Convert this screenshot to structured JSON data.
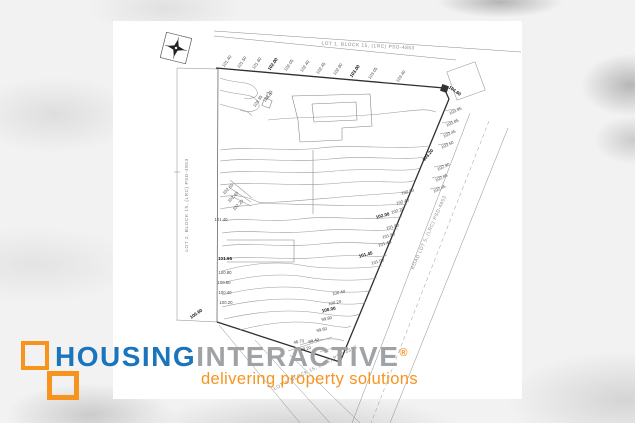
{
  "image": {
    "description": "Topographic contour survey plan of a subdivision lot (property listing photo)",
    "background_color": "#f2f2f2",
    "photo_background": "#ffffff"
  },
  "logo": {
    "word1": "HOUSING",
    "word2": "INTERACTIVE",
    "registered": "®",
    "tagline": "delivering property solutions",
    "colors": {
      "blue": "#1b75bc",
      "gray": "#a0a3a6",
      "orange": "#f7941e"
    }
  },
  "map": {
    "parcel_labels": [
      {
        "t": "LOT 1, BLOCK 15, (LRC) PSD-4853",
        "x": 368,
        "y": 47,
        "r": 3
      },
      {
        "t": "LOT 2, BLOCK 15, (LRC) PSD-4853",
        "x": 188,
        "y": 205,
        "r": -90
      },
      {
        "t": "ROAD LOT 5, (LRC) PSD-4853",
        "x": 430,
        "y": 233,
        "r": -66
      },
      {
        "t": "LOT 4, BLOCK 15, (LRC) PSD-4853",
        "x": 316,
        "y": 369,
        "r": -27
      }
    ],
    "elevation_labels": [
      {
        "t": "101.40",
        "x": 228,
        "y": 62,
        "r": -55
      },
      {
        "t": "101.50",
        "x": 243,
        "y": 63,
        "r": -55
      },
      {
        "t": "101.80",
        "x": 258,
        "y": 64,
        "r": -55
      },
      {
        "t": "102.00",
        "x": 274,
        "y": 65,
        "r": -55,
        "b": true
      },
      {
        "t": "102.05",
        "x": 290,
        "y": 66,
        "r": -55
      },
      {
        "t": "102.40",
        "x": 306,
        "y": 67,
        "r": -55
      },
      {
        "t": "102.45",
        "x": 322,
        "y": 69,
        "r": -55
      },
      {
        "t": "102.90",
        "x": 339,
        "y": 70,
        "r": -55
      },
      {
        "t": "103.00",
        "x": 356,
        "y": 72,
        "r": -55,
        "b": true
      },
      {
        "t": "103.05",
        "x": 374,
        "y": 74,
        "r": -55
      },
      {
        "t": "103.40",
        "x": 402,
        "y": 77,
        "r": -55
      },
      {
        "t": "103.35",
        "x": 259,
        "y": 102,
        "r": -55
      },
      {
        "t": "103.45",
        "x": 269,
        "y": 97,
        "r": -55
      },
      {
        "t": "104.60",
        "x": 454,
        "y": 92,
        "r": 35,
        "b": true
      },
      {
        "t": "103.95",
        "x": 456,
        "y": 112,
        "r": -25
      },
      {
        "t": "103.85",
        "x": 453,
        "y": 124,
        "r": -25
      },
      {
        "t": "103.45",
        "x": 450,
        "y": 135,
        "r": -25
      },
      {
        "t": "103.50",
        "x": 448,
        "y": 146,
        "r": -25
      },
      {
        "t": "103.20",
        "x": 429,
        "y": 156,
        "r": -50,
        "b": true
      },
      {
        "t": "102.90",
        "x": 444,
        "y": 168,
        "r": -25
      },
      {
        "t": "102.85",
        "x": 442,
        "y": 179,
        "r": -25
      },
      {
        "t": "102.45",
        "x": 440,
        "y": 190,
        "r": -25
      },
      {
        "t": "102.80",
        "x": 408,
        "y": 193,
        "r": -15
      },
      {
        "t": "102.40",
        "x": 403,
        "y": 203,
        "r": -15
      },
      {
        "t": "102.20",
        "x": 398,
        "y": 212,
        "r": -15
      },
      {
        "t": "102.00",
        "x": 383,
        "y": 217,
        "r": -15,
        "b": true
      },
      {
        "t": "101.80",
        "x": 393,
        "y": 228,
        "r": -15
      },
      {
        "t": "101.60",
        "x": 389,
        "y": 237,
        "r": -15
      },
      {
        "t": "101.40",
        "x": 385,
        "y": 245,
        "r": -15
      },
      {
        "t": "101.45",
        "x": 366,
        "y": 256,
        "r": -15,
        "b": true
      },
      {
        "t": "101.00",
        "x": 378,
        "y": 263,
        "r": -15
      },
      {
        "t": "102.60",
        "x": 229,
        "y": 190,
        "r": -45
      },
      {
        "t": "102.40",
        "x": 234,
        "y": 198,
        "r": -45
      },
      {
        "t": "102.20",
        "x": 239,
        "y": 206,
        "r": -45
      },
      {
        "t": "101.40",
        "x": 221,
        "y": 221,
        "r": 0
      },
      {
        "t": "101.95",
        "x": 225,
        "y": 260,
        "r": 0,
        "b": true
      },
      {
        "t": "100.80",
        "x": 225,
        "y": 274,
        "r": 0
      },
      {
        "t": "100.60",
        "x": 224,
        "y": 284,
        "r": 0
      },
      {
        "t": "100.40",
        "x": 225,
        "y": 294,
        "r": 0
      },
      {
        "t": "100.20",
        "x": 226,
        "y": 304,
        "r": 0
      },
      {
        "t": "100.60",
        "x": 197,
        "y": 315,
        "r": -35,
        "b": true
      },
      {
        "t": "100.40",
        "x": 339,
        "y": 294,
        "r": -12
      },
      {
        "t": "100.20",
        "x": 335,
        "y": 304,
        "r": -12
      },
      {
        "t": "100.00",
        "x": 329,
        "y": 311,
        "r": -12,
        "b": true
      },
      {
        "t": "99.80",
        "x": 327,
        "y": 320,
        "r": -12
      },
      {
        "t": "99.60",
        "x": 322,
        "y": 331,
        "r": -12
      },
      {
        "t": "99.40",
        "x": 314,
        "y": 342,
        "r": -12
      },
      {
        "t": "99.20",
        "x": 306,
        "y": 350,
        "r": -12
      },
      {
        "t": "46.73",
        "x": 299,
        "y": 343,
        "r": -10
      }
    ]
  }
}
